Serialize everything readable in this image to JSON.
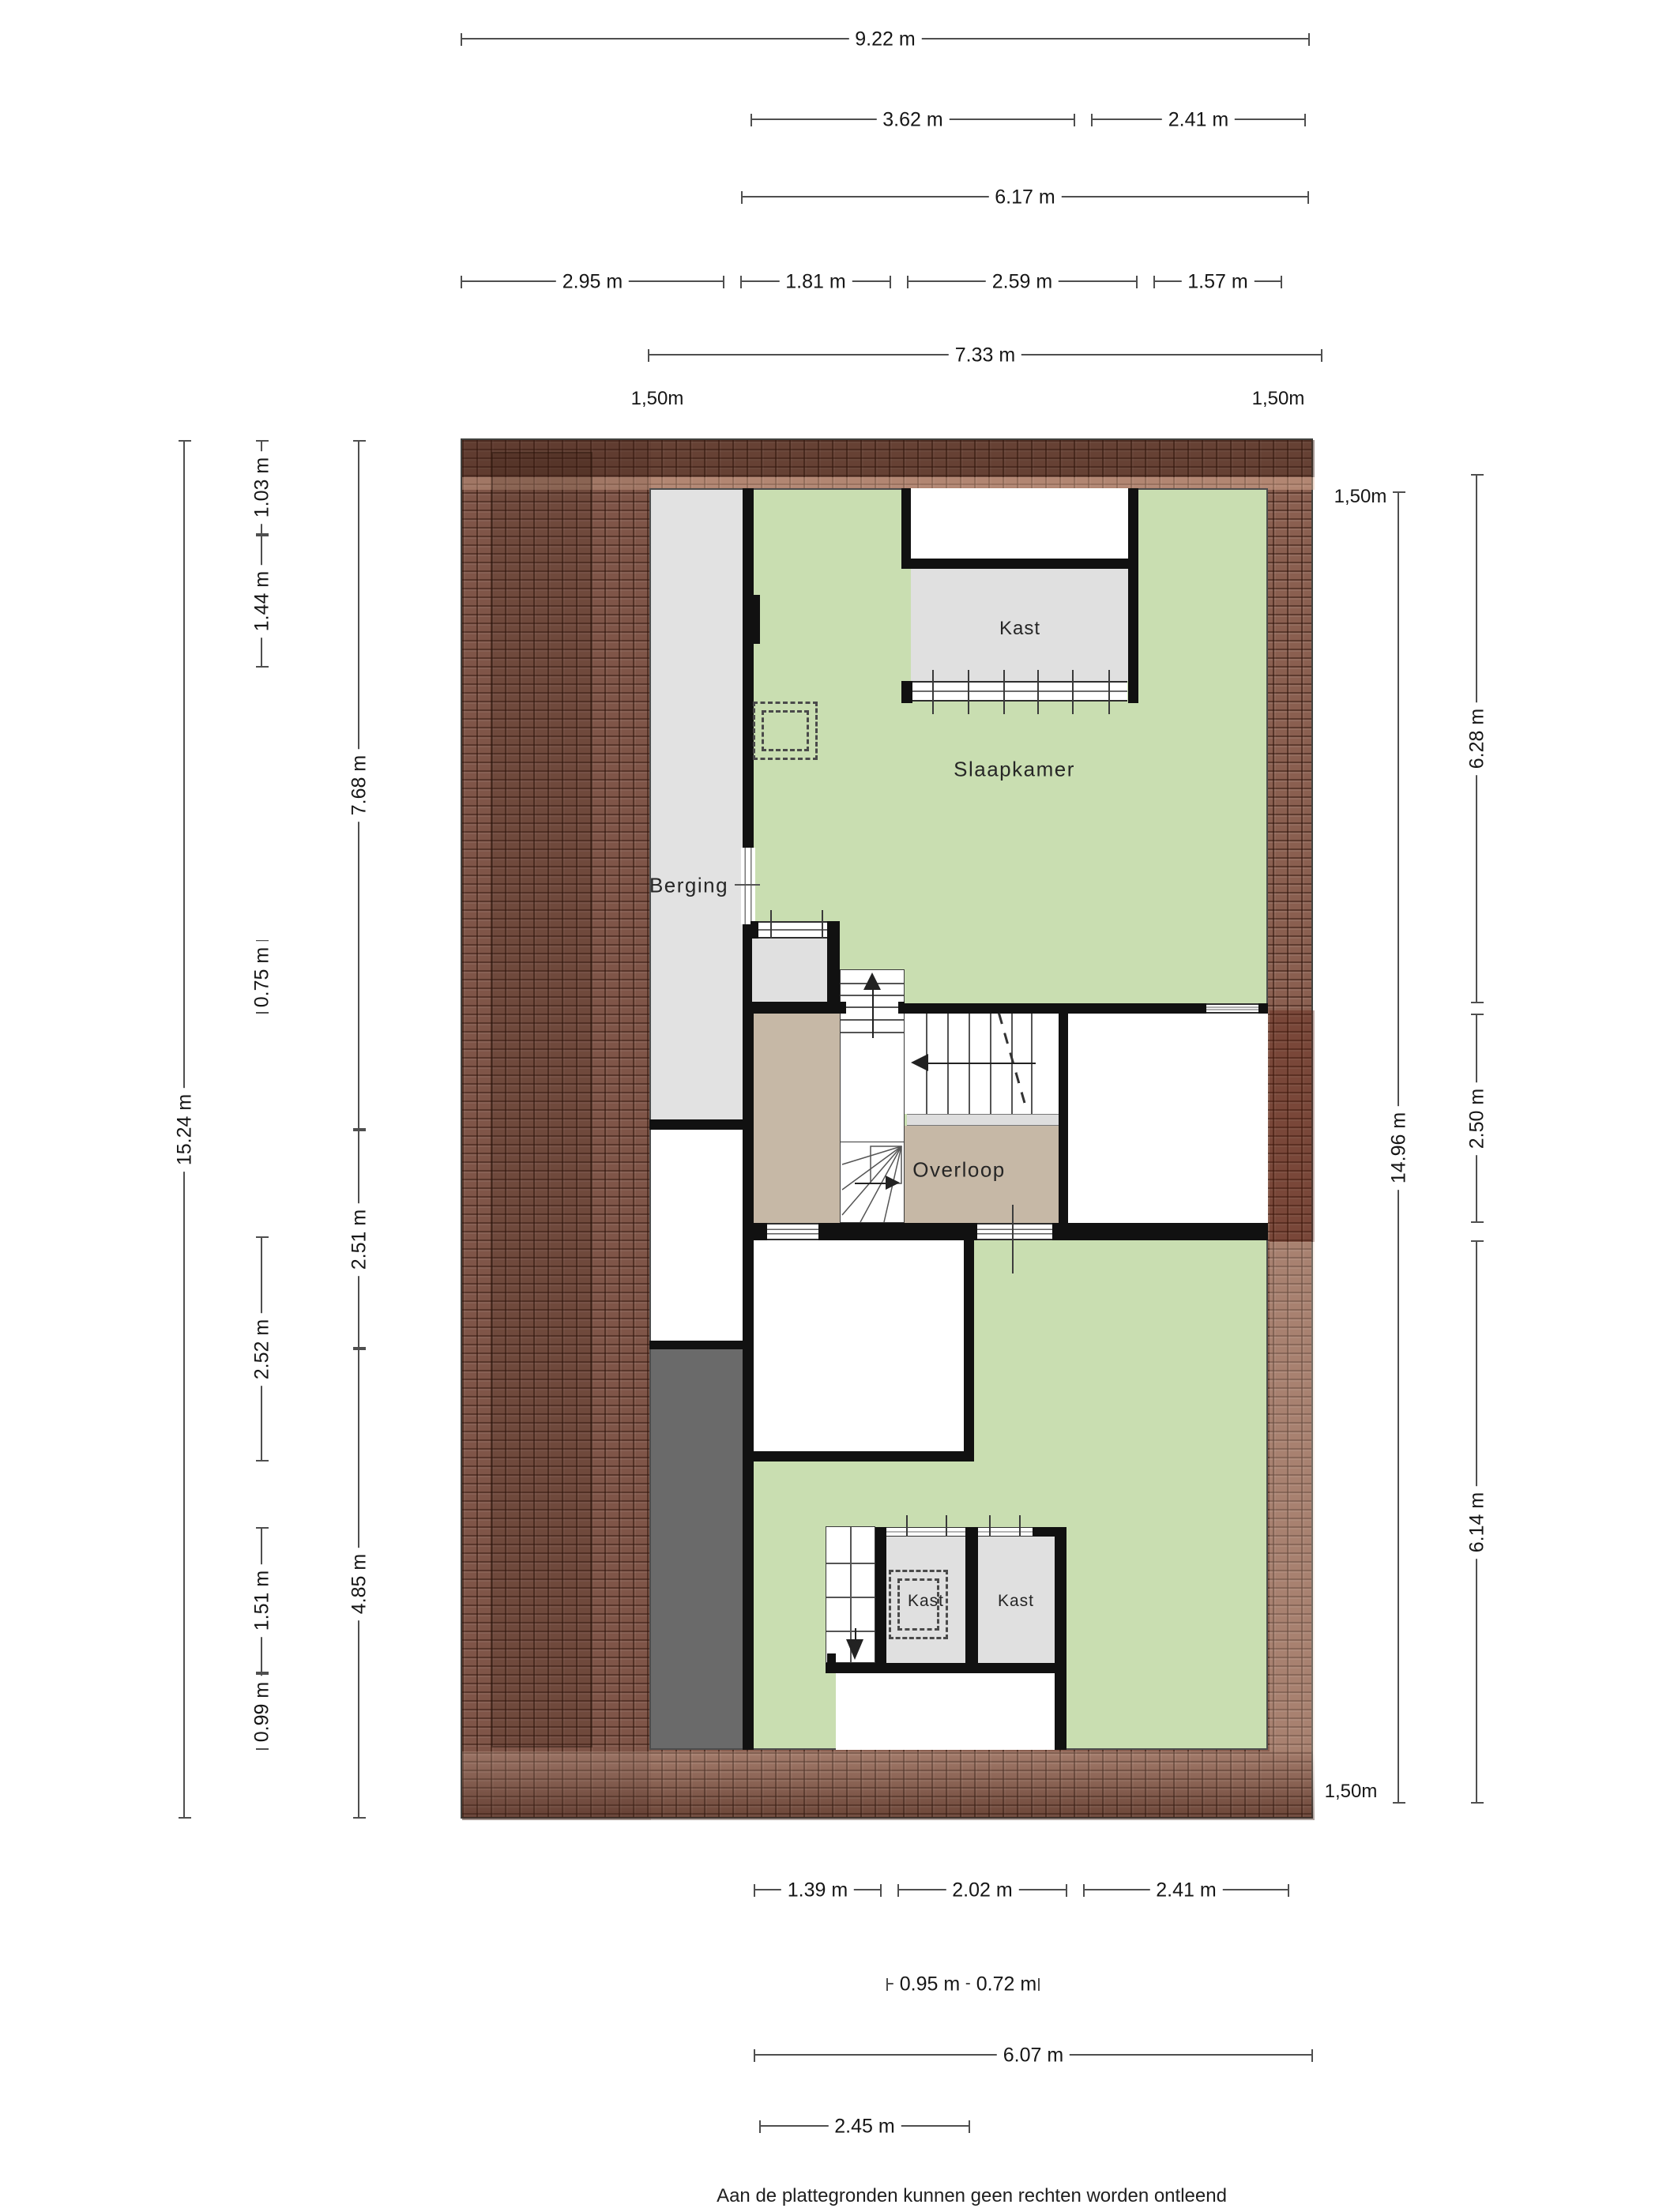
{
  "meta": {
    "footer_line1": "Aan de plattegronden kunnen geen rechten worden ontleend",
    "footer_line2": "© Zibber www.zibber.nl"
  },
  "rooms": {
    "berging": "Berging",
    "slaapkamer": "Slaapkamer",
    "kast_top": "Kast",
    "overloop": "Overloop",
    "kast_bottom_left": "Kast",
    "kast_bottom_right": "Kast"
  },
  "dims": {
    "top": {
      "total": "9.22 m",
      "a": "3.62 m",
      "b": "2.41 m",
      "inner": "6.17 m",
      "s1": "2.95 m",
      "s2": "1.81 m",
      "s3": "2.59 m",
      "s4": "1.57 m",
      "total2": "7.33 m"
    },
    "left": {
      "total": "15.24 m",
      "a": "1.03 m",
      "b": "1.44 m",
      "c": "0.75 m",
      "d": "2.52 m",
      "e": "1.51 m",
      "f": "0.99 m",
      "g": "7.68 m",
      "h": "2.51 m",
      "i": "4.85 m"
    },
    "right": {
      "total": "14.96 m",
      "a": "6.28 m",
      "b": "2.50 m",
      "c": "6.14 m"
    },
    "bottom": {
      "a": "1.39 m",
      "b": "2.02 m",
      "c": "2.41 m",
      "d": "0.95 m",
      "e": "0.72 m",
      "f": "6.07 m",
      "g": "2.45 m"
    },
    "headroom": "1,50m"
  },
  "colors": {
    "room_green": "#c9deb1",
    "room_tan": "#c6b8a6",
    "light_gray": "#e2e2e2",
    "dark_gray": "#6a6a6a",
    "roof_brown": "#8a5f50",
    "wall_black": "#111111"
  }
}
